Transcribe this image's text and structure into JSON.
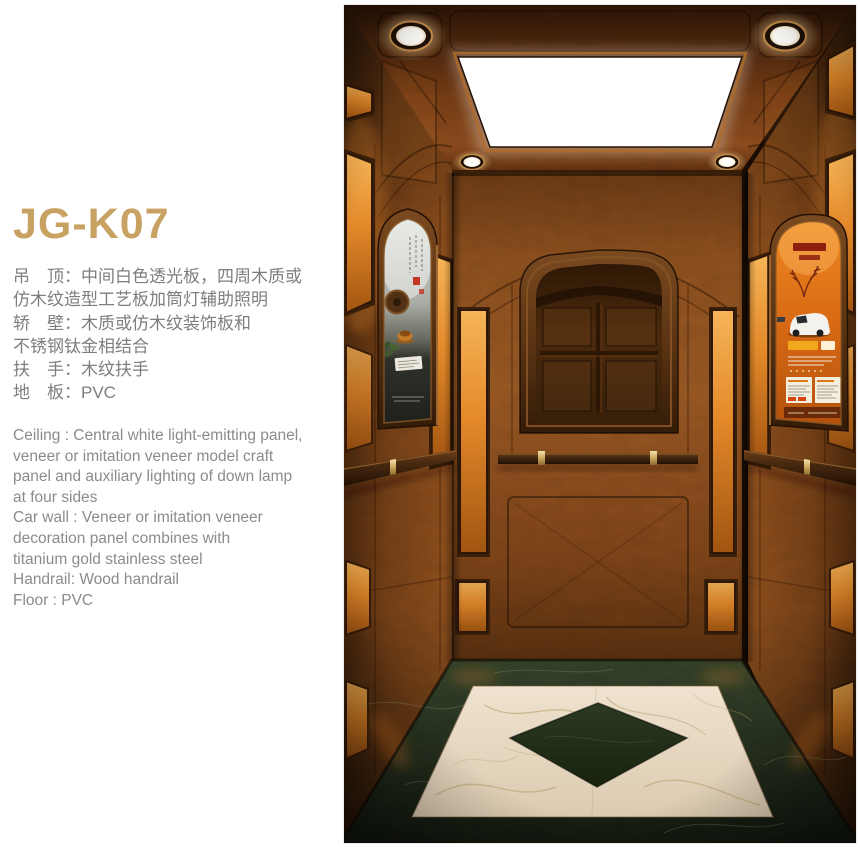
{
  "spec_sheet": {
    "model": "JG-K07",
    "title_color": "#c8a262",
    "zh_text_color": "#7e7e7e",
    "en_text_color": "#8b8b8b",
    "specs_zh": [
      "吊　顶：中间白色透光板，四周木质或",
      "仿木纹造型工艺板加筒灯辅助照明",
      "轿　壁：木质或仿木纹装饰板和",
      "不锈钢钛金相结合",
      "扶　手：木纹扶手",
      "地　板：PVC"
    ],
    "specs_en": [
      "Ceiling : Central white light-emitting panel,",
      "veneer or imitation veneer model craft",
      "panel and auxiliary lighting of down lamp",
      "at four sides",
      "Car wall : Veneer or imitation veneer",
      "decoration panel combines with",
      "titanium gold stainless steel",
      "Handrail: Wood handrail",
      "Floor : PVC"
    ]
  },
  "scene": {
    "label": "Elevator car interior render",
    "colors": {
      "ceiling_copper": "#7a3f16",
      "wall_wood": "#a05d26",
      "side_wall_wood": "#96541f",
      "lit_panel": "#e3892a",
      "light_white": "#ffffff",
      "frame_wood": "#5b3413",
      "handrail_wood": "#4a2a10",
      "brass": "#d3b067",
      "floor_green": "#38462e",
      "floor_marble": "#efe3cf",
      "floor_diamond": "#2c3a22",
      "poster_orange": "#d96a14"
    }
  }
}
